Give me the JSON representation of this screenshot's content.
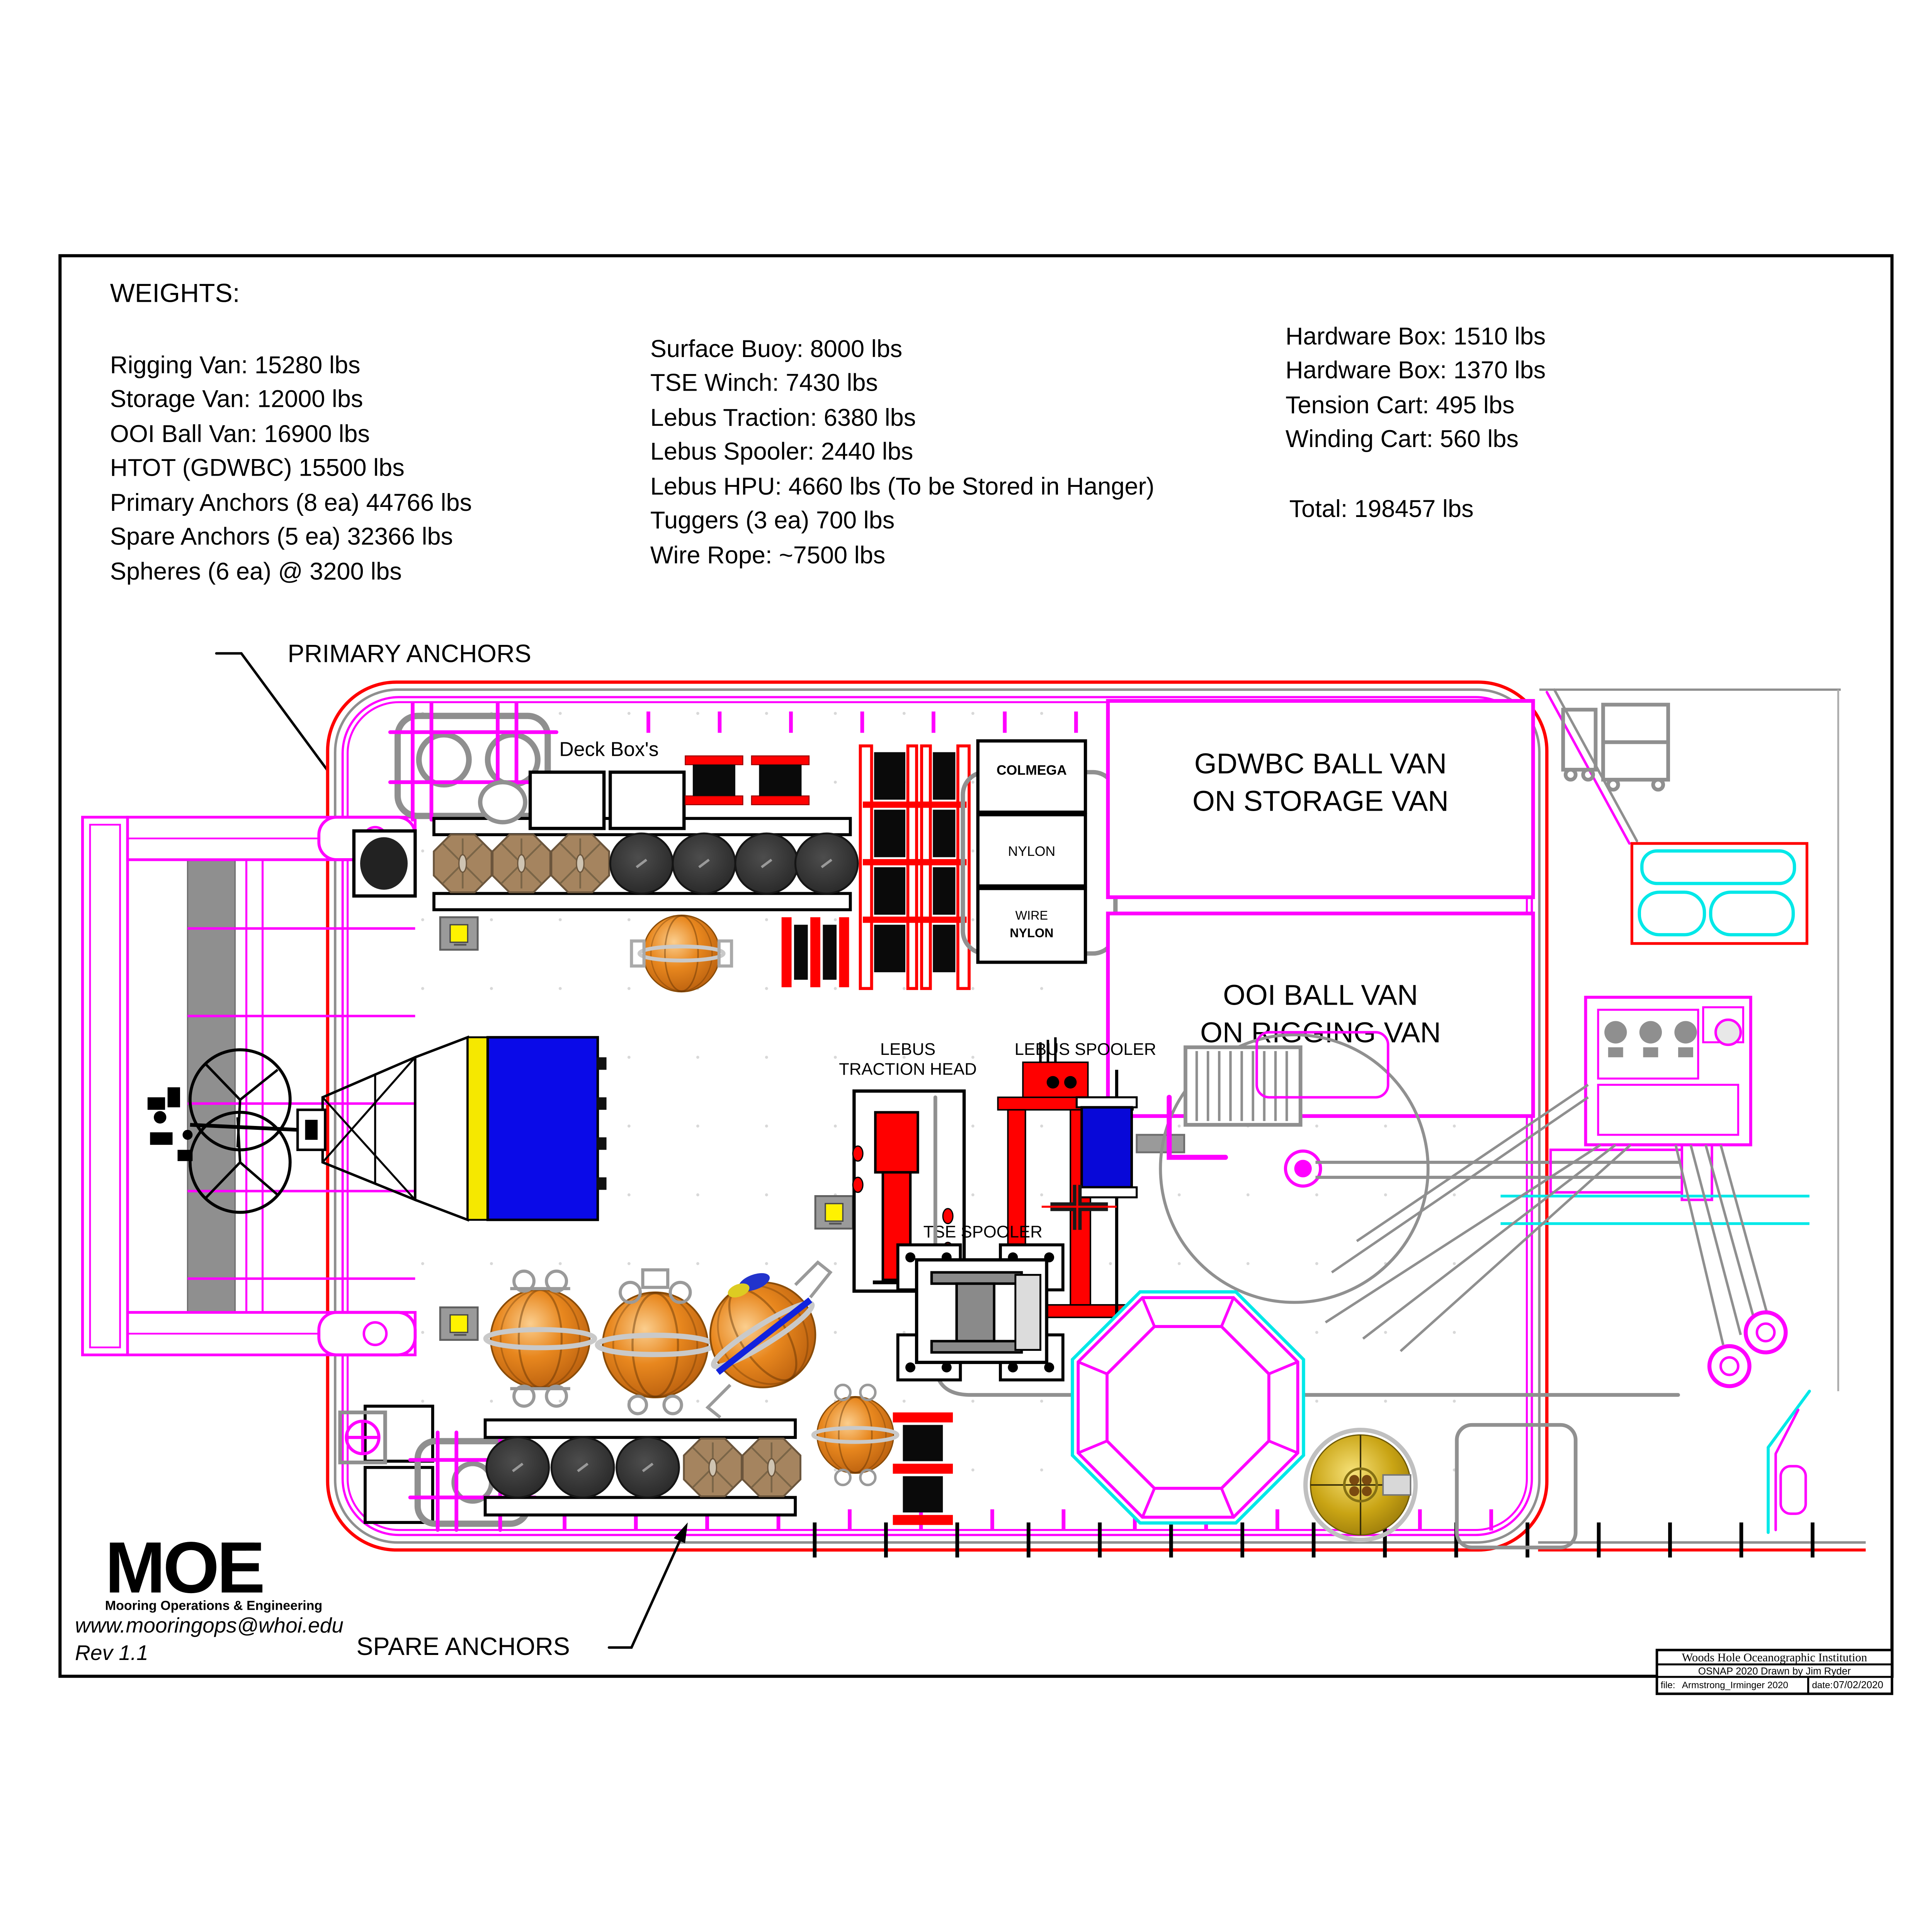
{
  "weights": {
    "title": "WEIGHTS:",
    "col1": [
      "Rigging Van: 15280 lbs",
      "Storage Van: 12000 lbs",
      "OOI Ball Van: 16900 lbs",
      "HTOT (GDWBC) 15500 lbs",
      "Primary Anchors (8 ea) 44766 lbs",
      "Spare Anchors (5 ea) 32366 lbs",
      "Spheres (6 ea) @ 3200 lbs"
    ],
    "col2": [
      "Surface Buoy: 8000 lbs",
      "TSE Winch: 7430 lbs",
      "Lebus Traction: 6380 lbs",
      "Lebus Spooler: 2440 lbs",
      "Lebus HPU: 4660 lbs (To be Stored in Hanger)",
      "Tuggers (3 ea) 700 lbs",
      "Wire Rope: ~7500 lbs"
    ],
    "col3": [
      "Hardware Box: 1510 lbs",
      "Hardware Box: 1370 lbs",
      "Tension Cart: 495 lbs",
      "Winding Cart: 560 lbs"
    ],
    "total": "Total: 198457 lbs"
  },
  "labels": {
    "primary_anchors": "PRIMARY ANCHORS",
    "spare_anchors": "SPARE ANCHORS",
    "deck_boxes": "Deck Box's",
    "colmega": "COLMEGA",
    "nylon": "NYLON",
    "wire": "WIRE",
    "wire_nylon": "NYLON",
    "gdwbc_line1": "GDWBC BALL VAN",
    "gdwbc_line2": "ON STORAGE VAN",
    "ooi_line1": "OOI BALL VAN",
    "ooi_line2": "ON RIGGING VAN",
    "lebus_traction_line1": "LEBUS",
    "lebus_traction_line2": "TRACTION HEAD",
    "lebus_spooler": "LEBUS SPOOLER",
    "tse_spooler": "TSE SPOOLER"
  },
  "footer": {
    "logo": "MOE",
    "tagline": "Mooring Operations & Engineering",
    "website": "www.mooringops@whoi.edu",
    "revision": "Rev 1.1"
  },
  "title_block": {
    "institution": "Woods Hole Oceanographic Institution",
    "project": "OSNAP 2020  Drawn by Jim Ryder",
    "file_label": "file:",
    "file_value": "Armstrong_Irminger 2020",
    "date_label": "date:",
    "date_value": "07/02/2020"
  },
  "colors": {
    "deck_outline_red": "#FF0000",
    "rail_magenta": "#FF00FF",
    "wire_cyan": "#00E8E8",
    "spool_blue": "#0808D8",
    "buoy_blue": "#0A0AE8",
    "buoy_yellow": "#F5E800",
    "pad_eye_yellow": "#FFF200",
    "sphere_orange": "#E07818",
    "glass_sphere_gold": "#C9A414",
    "machine_gray": "#8F8F8F",
    "logo_blue": "#1878BE",
    "logo_yellow": "#EFCA2F"
  }
}
